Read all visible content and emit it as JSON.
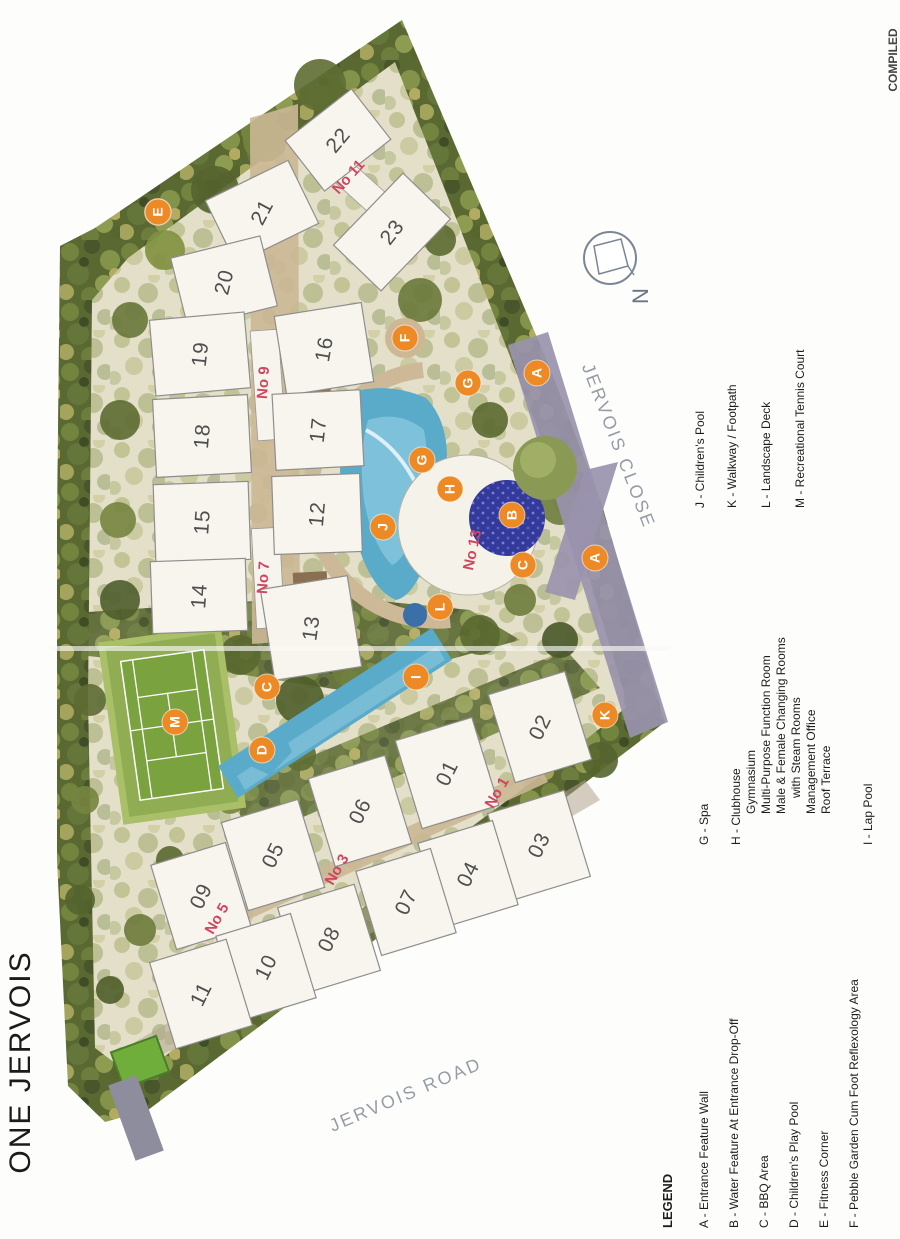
{
  "title": "ONE JERVOIS",
  "compiled_note": "COMPILED",
  "compass": {
    "label": "N"
  },
  "colors": {
    "marker_fill": "#ee8a25",
    "marker_text": "#ffffff",
    "block_label": "#d0455f",
    "building_fill": "#f8f5ee",
    "building_stroke": "#8e8e8e",
    "building_number": "#4f4f4f",
    "road_text": "#969ca6",
    "legend_text": "#1d1d1d",
    "pool": "#5aabca",
    "water_feature": "#333a9b",
    "tennis_green": "#7aa23f"
  },
  "roads": [
    {
      "name": "JERVOIS ROAD",
      "x": 408,
      "y": 1100,
      "rot": -23
    },
    {
      "name": "JERVOIS CLOSE",
      "x": 613,
      "y": 448,
      "rot": 69
    }
  ],
  "block_labels": [
    {
      "text": "No 11",
      "x": 352,
      "y": 180,
      "rot": -48
    },
    {
      "text": "No 9",
      "x": 268,
      "y": 383,
      "rot": -86
    },
    {
      "text": "No 7",
      "x": 268,
      "y": 578,
      "rot": -86
    },
    {
      "text": "No 13",
      "x": 477,
      "y": 551,
      "rot": -78
    },
    {
      "text": "No 1",
      "x": 501,
      "y": 795,
      "rot": -60
    },
    {
      "text": "No 3",
      "x": 341,
      "y": 872,
      "rot": -60
    },
    {
      "text": "No 5",
      "x": 221,
      "y": 921,
      "rot": -60
    }
  ],
  "buildings": [
    {
      "label": "22",
      "x": 338,
      "y": 140,
      "w": 84,
      "h": 64,
      "rot": -38,
      "text_rot": -50
    },
    {
      "label": "21",
      "x": 262,
      "y": 212,
      "w": 92,
      "h": 70,
      "rot": -26,
      "text_rot": -62
    },
    {
      "label": "20",
      "x": 224,
      "y": 282,
      "w": 92,
      "h": 72,
      "rot": -14,
      "text_rot": -76
    },
    {
      "label": "19",
      "x": 200,
      "y": 354,
      "w": 95,
      "h": 76,
      "rot": -5,
      "text_rot": -84
    },
    {
      "label": "18",
      "x": 202,
      "y": 436,
      "w": 95,
      "h": 78,
      "rot": -3,
      "text_rot": -85
    },
    {
      "label": "15",
      "x": 202,
      "y": 522,
      "w": 95,
      "h": 78,
      "rot": -2,
      "text_rot": -86
    },
    {
      "label": "14",
      "x": 199,
      "y": 596,
      "w": 95,
      "h": 72,
      "rot": -2,
      "text_rot": -86
    },
    {
      "label": "23",
      "x": 392,
      "y": 232,
      "w": 100,
      "h": 66,
      "rot": -46,
      "text_rot": -52
    },
    {
      "label": "16",
      "x": 324,
      "y": 349,
      "w": 88,
      "h": 80,
      "rot": -9,
      "text_rot": -80
    },
    {
      "label": "17",
      "x": 318,
      "y": 430,
      "w": 88,
      "h": 76,
      "rot": -3,
      "text_rot": -84
    },
    {
      "label": "12",
      "x": 317,
      "y": 514,
      "w": 88,
      "h": 78,
      "rot": -2,
      "text_rot": -85
    },
    {
      "label": "13",
      "x": 311,
      "y": 628,
      "w": 88,
      "h": 92,
      "rot": -9,
      "text_rot": -82
    },
    {
      "label": "02",
      "x": 540,
      "y": 727,
      "w": 80,
      "h": 92,
      "rot": -17,
      "text_rot": -64
    },
    {
      "label": "01",
      "x": 447,
      "y": 773,
      "w": 80,
      "h": 92,
      "rot": -17,
      "text_rot": -64
    },
    {
      "label": "06",
      "x": 360,
      "y": 811,
      "w": 80,
      "h": 92,
      "rot": -17,
      "text_rot": -64
    },
    {
      "label": "05",
      "x": 273,
      "y": 855,
      "w": 80,
      "h": 92,
      "rot": -17,
      "text_rot": -64
    },
    {
      "label": "09",
      "x": 201,
      "y": 896,
      "w": 78,
      "h": 88,
      "rot": -17,
      "text_rot": -64
    },
    {
      "label": "03",
      "x": 539,
      "y": 845,
      "w": 80,
      "h": 90,
      "rot": -17,
      "text_rot": -64
    },
    {
      "label": "04",
      "x": 468,
      "y": 874,
      "w": 78,
      "h": 88,
      "rot": -17,
      "text_rot": -64
    },
    {
      "label": "07",
      "x": 406,
      "y": 902,
      "w": 78,
      "h": 88,
      "rot": -17,
      "text_rot": -64
    },
    {
      "label": "08",
      "x": 329,
      "y": 939,
      "w": 80,
      "h": 90,
      "rot": -17,
      "text_rot": -64
    },
    {
      "label": "10",
      "x": 266,
      "y": 967,
      "w": 78,
      "h": 88,
      "rot": -17,
      "text_rot": -64
    },
    {
      "label": "11",
      "x": 201,
      "y": 994,
      "w": 80,
      "h": 90,
      "rot": -17,
      "text_rot": -64
    }
  ],
  "markers": [
    {
      "letter": "E",
      "x": 158,
      "y": 212
    },
    {
      "letter": "F",
      "x": 405,
      "y": 338
    },
    {
      "letter": "A",
      "x": 537,
      "y": 373
    },
    {
      "letter": "G",
      "x": 468,
      "y": 383
    },
    {
      "letter": "G",
      "x": 422,
      "y": 460
    },
    {
      "letter": "H",
      "x": 450,
      "y": 489
    },
    {
      "letter": "B",
      "x": 512,
      "y": 515
    },
    {
      "letter": "J",
      "x": 383,
      "y": 527
    },
    {
      "letter": "C",
      "x": 523,
      "y": 565
    },
    {
      "letter": "A",
      "x": 595,
      "y": 558
    },
    {
      "letter": "L",
      "x": 440,
      "y": 607
    },
    {
      "letter": "I",
      "x": 416,
      "y": 677
    },
    {
      "letter": "C",
      "x": 267,
      "y": 687
    },
    {
      "letter": "M",
      "x": 175,
      "y": 722
    },
    {
      "letter": "D",
      "x": 262,
      "y": 750
    },
    {
      "letter": "K",
      "x": 605,
      "y": 715
    }
  ],
  "legend": {
    "heading": "LEGEND",
    "lines": [
      {
        "t": "LEGEND",
        "x": 672,
        "y": 1228,
        "bold": true,
        "size": 13
      },
      {
        "t": "A - Entrance Feature Wall",
        "x": 708,
        "y": 1228
      },
      {
        "t": "B - Water Feature At Entrance Drop-Off",
        "x": 738,
        "y": 1228
      },
      {
        "t": "C - BBQ Area",
        "x": 768,
        "y": 1228
      },
      {
        "t": "D - Children's Play Pool",
        "x": 798,
        "y": 1228
      },
      {
        "t": "E - Fitness Corner",
        "x": 828,
        "y": 1228
      },
      {
        "t": "F - Pebble Garden Cum Foot Reflexology Area",
        "x": 858,
        "y": 1228
      },
      {
        "t": "G - Spa",
        "x": 708,
        "y": 845
      },
      {
        "t": "H - Clubhouse",
        "x": 740,
        "y": 845
      },
      {
        "t": "Gymnasium",
        "x": 755,
        "y": 814
      },
      {
        "t": "Multi-Purpose Function Room",
        "x": 770,
        "y": 814
      },
      {
        "t": "Male & Female Changing Rooms",
        "x": 785,
        "y": 814
      },
      {
        "t": "with Steam Rooms",
        "x": 800,
        "y": 798
      },
      {
        "t": "Management Office",
        "x": 815,
        "y": 814
      },
      {
        "t": "Roof Terrace",
        "x": 830,
        "y": 814
      },
      {
        "t": "I  - Lap Pool",
        "x": 872,
        "y": 845
      },
      {
        "t": "J - Children's Pool",
        "x": 704,
        "y": 508
      },
      {
        "t": "K - Walkway / Footpath",
        "x": 736,
        "y": 508
      },
      {
        "t": "L - Landscape Deck",
        "x": 770,
        "y": 508
      },
      {
        "t": "M - Recreational Tennis  Court",
        "x": 804,
        "y": 508
      }
    ]
  }
}
